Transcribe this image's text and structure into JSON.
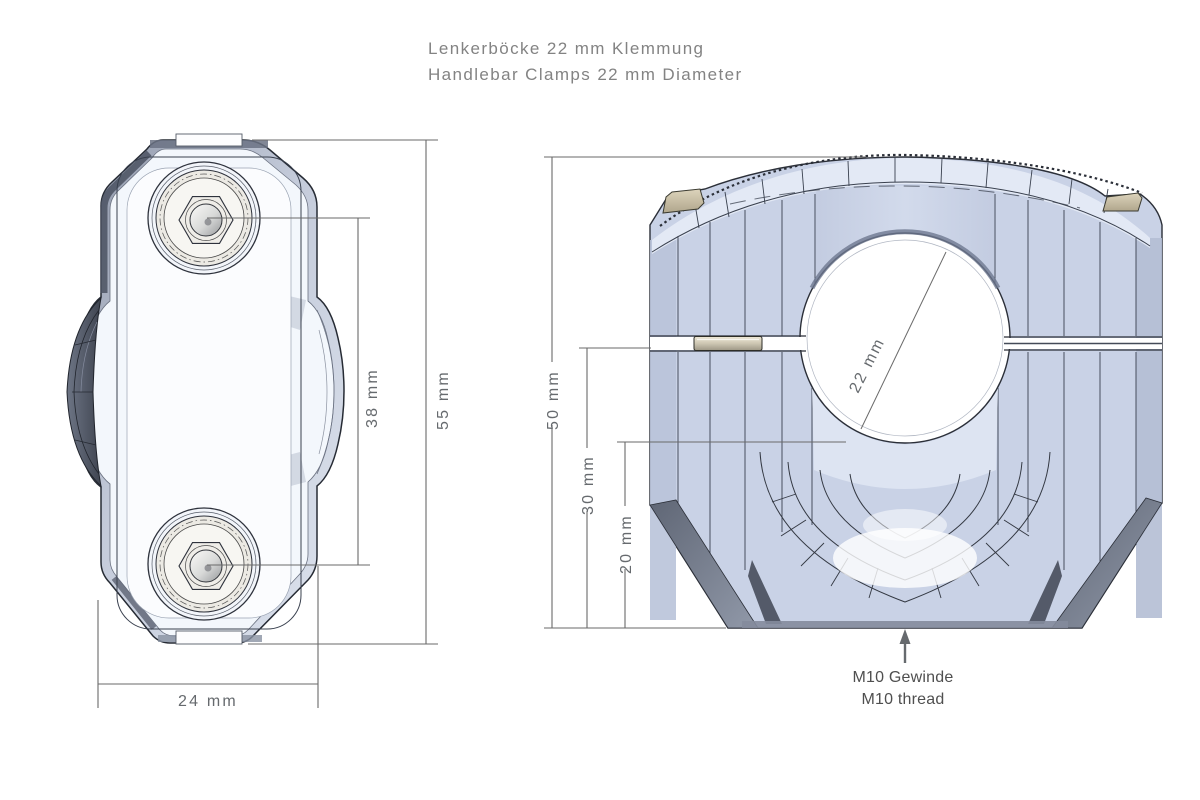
{
  "title": {
    "line1": "Lenkerböcke 22 mm Klemmung",
    "line2": "Handlebar Clamps 22 mm Diameter"
  },
  "top_view": {
    "dims": {
      "width": "24 mm",
      "bolt_spacing": "38 mm",
      "total_length": "55 mm"
    }
  },
  "front_view": {
    "dims": {
      "total_height": "50 mm",
      "mid_height": "30 mm",
      "lower_height": "20 mm",
      "bore_diameter": "22 mm"
    },
    "thread_note": {
      "de": "M10 Gewinde",
      "en": "M10 thread"
    }
  },
  "colors": {
    "body_light": "#dde4f2",
    "body_mid": "#c9d2e6",
    "edge_dark": "#2b2f38",
    "dim_line": "#6a6a6a",
    "screw_tan": "#cfc5ac",
    "title_gray": "#838383"
  }
}
